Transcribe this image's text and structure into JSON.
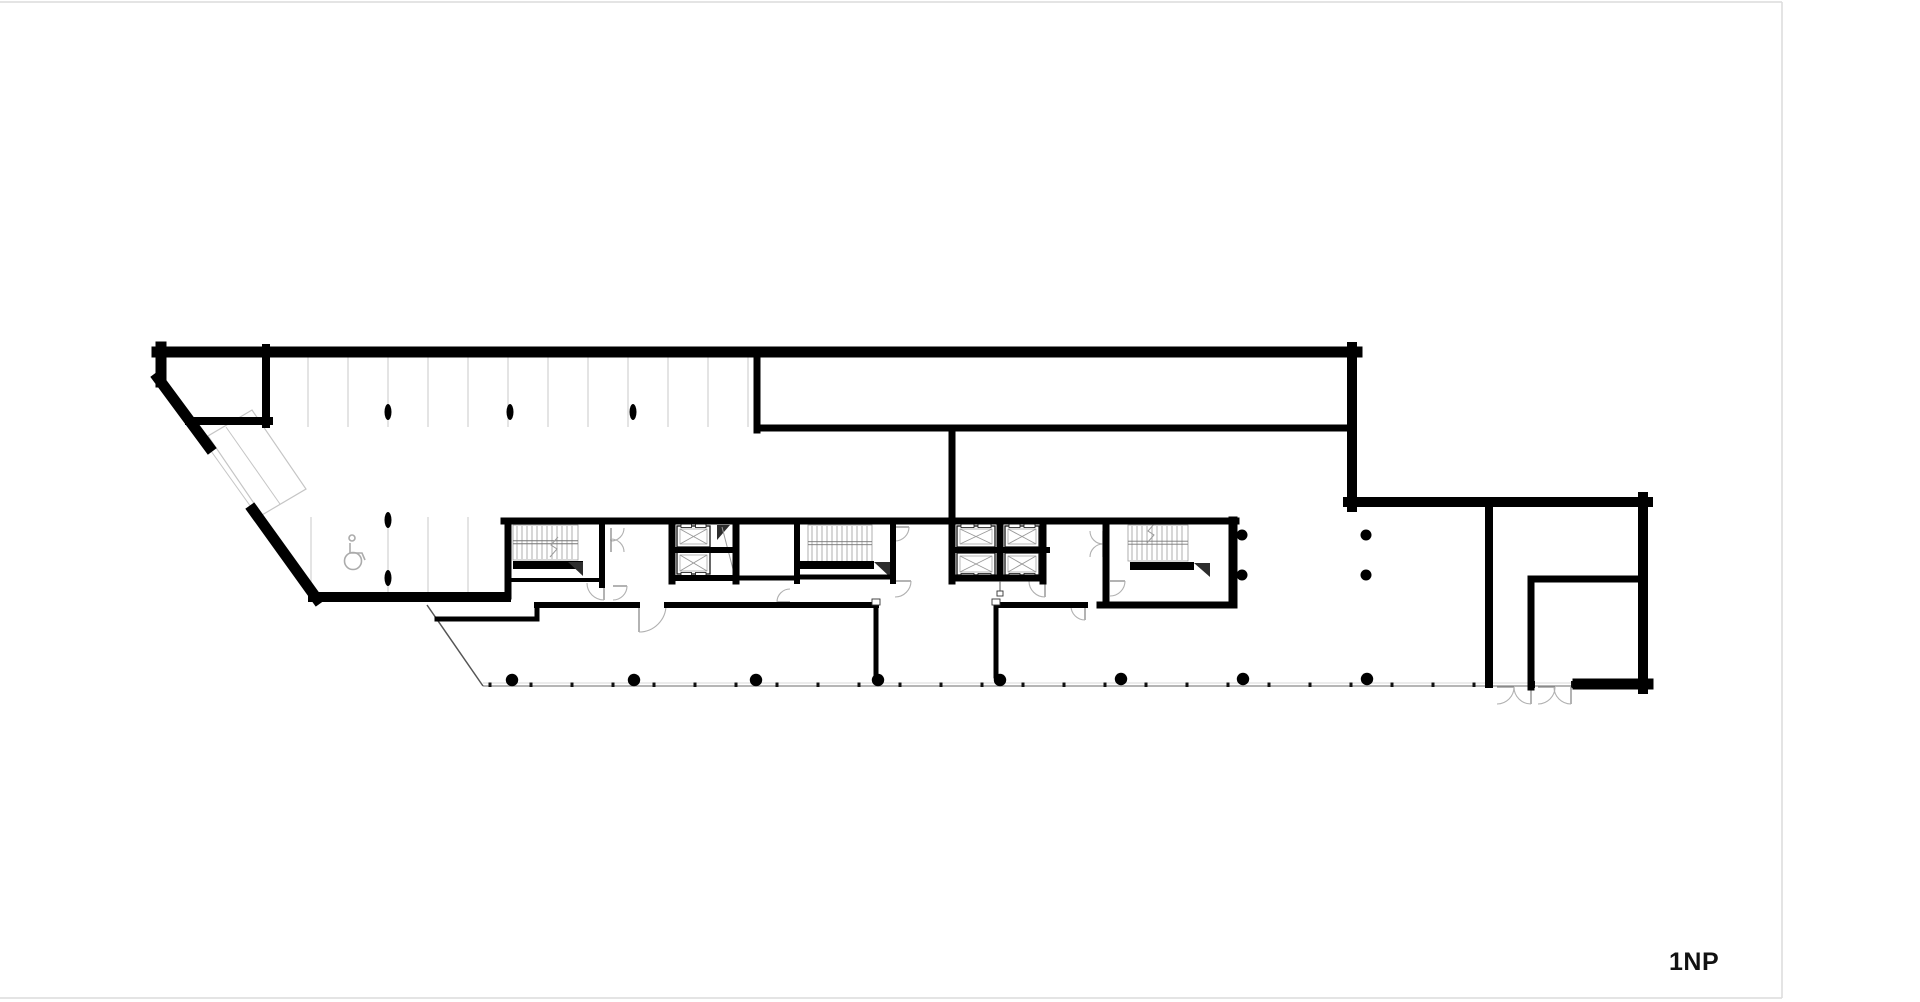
{
  "label": {
    "text": "1NP"
  },
  "page": {
    "width": 1782,
    "height": 998,
    "border_color": "#dcdcdc",
    "background": "#ffffff"
  },
  "colors": {
    "wall": "#000000",
    "detail": "#9b9b9b",
    "stripe": "#d2d2d2",
    "ramp": "#c5c5c5",
    "door": "#b0b0b0",
    "door_leaf": "#8a8a8a",
    "wedge": "#2d2d2d",
    "facade": "#8a8a8a",
    "facade_light": "#d8d8d8",
    "icon": "#ababab",
    "glazing": "#555555",
    "text": "#111111"
  },
  "plan": {
    "walls": [
      [
        157,
        352,
        1357,
        352,
        11
      ],
      [
        1352,
        347,
        1352,
        507,
        10
      ],
      [
        1348,
        502,
        1648,
        502,
        10
      ],
      [
        1643,
        497,
        1643,
        689,
        10
      ],
      [
        1578,
        684,
        1648,
        684,
        11
      ],
      [
        161,
        347,
        161,
        382,
        11
      ],
      [
        158,
        378,
        209,
        447,
        11
      ],
      [
        253,
        510,
        317,
        599,
        11
      ],
      [
        313,
        597,
        506,
        597,
        10
      ],
      [
        266,
        348,
        266,
        424,
        8
      ],
      [
        189,
        421,
        269,
        421,
        8
      ],
      [
        757,
        353,
        757,
        430,
        7
      ],
      [
        757,
        428,
        1351,
        428,
        7
      ],
      [
        952,
        428,
        952,
        581,
        7
      ],
      [
        504,
        521,
        1236,
        521,
        7
      ],
      [
        508,
        521,
        508,
        596,
        7
      ],
      [
        602,
        524,
        602,
        585,
        6
      ],
      [
        672,
        521,
        672,
        581,
        7
      ],
      [
        736,
        521,
        736,
        581,
        7
      ],
      [
        797,
        521,
        797,
        581,
        6
      ],
      [
        893,
        521,
        893,
        581,
        6
      ],
      [
        1000,
        524,
        1000,
        578,
        7
      ],
      [
        1043,
        521,
        1043,
        581,
        7
      ],
      [
        1106,
        521,
        1106,
        604,
        7
      ],
      [
        1233,
        521,
        1233,
        604,
        9
      ],
      [
        952,
        550,
        1047,
        550,
        6
      ],
      [
        952,
        578,
        1043,
        578,
        7
      ],
      [
        672,
        550,
        736,
        550,
        6
      ],
      [
        672,
        578,
        736,
        578,
        6
      ],
      [
        736,
        578,
        797,
        578,
        5
      ],
      [
        508,
        580,
        602,
        580,
        4
      ],
      [
        797,
        577,
        893,
        577,
        5
      ],
      [
        537,
        605,
        637,
        605,
        6
      ],
      [
        667,
        605,
        876,
        605,
        6
      ],
      [
        1000,
        605,
        1085,
        605,
        6
      ],
      [
        1100,
        605,
        1233,
        605,
        7
      ],
      [
        437,
        619,
        537,
        619,
        5
      ],
      [
        537,
        605,
        537,
        619,
        5
      ],
      [
        876,
        605,
        876,
        676,
        5
      ],
      [
        996,
        605,
        996,
        676,
        5
      ],
      [
        1489,
        502,
        1489,
        684,
        8
      ],
      [
        1531,
        579,
        1531,
        687,
        7
      ],
      [
        1531,
        579,
        1643,
        579,
        7
      ]
    ],
    "glazing_diagonal": [
      427,
      605,
      483,
      686
    ],
    "stair_bands": [
      [
        513,
        561,
        70,
        8
      ],
      [
        797,
        561,
        77,
        8
      ],
      [
        1130,
        562,
        64,
        8
      ]
    ],
    "wedges": [
      [
        568,
        562,
        583,
        562,
        583,
        576
      ],
      [
        874,
        562,
        890,
        562,
        890,
        577
      ],
      [
        1194,
        563,
        1210,
        563,
        1210,
        577
      ],
      [
        717,
        525,
        730,
        525,
        717,
        540
      ]
    ],
    "chute_line": [
      722,
      527,
      734,
      573
    ],
    "stairs": [
      {
        "x": 513,
        "y": 525,
        "w": 65,
        "h": 35
      },
      {
        "x": 808,
        "y": 525,
        "w": 64,
        "h": 37
      },
      {
        "x": 1128,
        "y": 525,
        "w": 60,
        "h": 36
      }
    ],
    "zigzags": [
      [
        550,
        557,
        557,
        549,
        551,
        545,
        558,
        537
      ],
      [
        1147,
        543,
        1154,
        535,
        1148,
        531,
        1155,
        523
      ]
    ],
    "elevators": [
      {
        "x": 677,
        "y": 526,
        "w": 33,
        "h": 21,
        "door": "top"
      },
      {
        "x": 677,
        "y": 552,
        "w": 33,
        "h": 22,
        "door": "bottom"
      },
      {
        "x": 957,
        "y": 526,
        "w": 38,
        "h": 21,
        "door": "top"
      },
      {
        "x": 1005,
        "y": 526,
        "w": 34,
        "h": 21,
        "door": "top"
      },
      {
        "x": 957,
        "y": 553,
        "w": 38,
        "h": 22,
        "door": "bottom"
      },
      {
        "x": 1005,
        "y": 553,
        "w": 34,
        "h": 22,
        "door": "bottom"
      }
    ],
    "doors": [
      [
        611,
        528,
        13,
        90,
        0
      ],
      [
        611,
        552,
        13,
        -90,
        0
      ],
      [
        604,
        583,
        17,
        90,
        180
      ],
      [
        613,
        586,
        14,
        0,
        90
      ],
      [
        639,
        605,
        27,
        90,
        0
      ],
      [
        895,
        527,
        14,
        0,
        90
      ],
      [
        895,
        581,
        16,
        0,
        90
      ],
      [
        1045,
        581,
        16,
        90,
        180
      ],
      [
        1103,
        531,
        13,
        90,
        180
      ],
      [
        1103,
        557,
        13,
        270,
        180
      ],
      [
        1110,
        581,
        15,
        0,
        90
      ],
      [
        1085,
        606,
        14,
        90,
        180
      ],
      [
        790,
        602,
        13,
        180,
        270
      ],
      [
        1497,
        687,
        17,
        0,
        90
      ],
      [
        1531,
        687,
        17,
        90,
        180
      ],
      [
        1538,
        687,
        17,
        0,
        90
      ],
      [
        1571,
        687,
        17,
        90,
        180
      ]
    ],
    "parking": {
      "top_xs": [
        308,
        348,
        388,
        428,
        468,
        508,
        548,
        588,
        628,
        668,
        708,
        748
      ],
      "top_y1": 356,
      "top_y2": 427,
      "low_xs": [
        311,
        388,
        428,
        468
      ],
      "low_y1": 517,
      "low_y2": 594
    },
    "ramp": {
      "outline": [
        252,
        410,
        306,
        489,
        262,
        515,
        208,
        436
      ],
      "mid_line": [
        226,
        427,
        280,
        504
      ],
      "opening_line": [
        206,
        444,
        256,
        514
      ]
    },
    "facade": {
      "x1": 483,
      "x2": 1578,
      "y": 686,
      "y_light": 683,
      "tick_xs": [
        490,
        531,
        572,
        613,
        654,
        695,
        736,
        777,
        818,
        859,
        900,
        941,
        982,
        1023,
        1064,
        1105,
        1146,
        1187,
        1228,
        1269,
        1310,
        1351,
        1392,
        1433,
        1474
      ],
      "post_xs": [
        1490,
        1533,
        1573
      ]
    },
    "columns": {
      "oval": [
        [
          388,
          412
        ],
        [
          510,
          412
        ],
        [
          633,
          412
        ],
        [
          388,
          520
        ],
        [
          388,
          578
        ]
      ],
      "round_large": [
        [
          512,
          680
        ],
        [
          634,
          680
        ],
        [
          756,
          680
        ],
        [
          878,
          680
        ],
        [
          1000,
          680
        ],
        [
          1121,
          679
        ],
        [
          1243,
          679
        ],
        [
          1367,
          679
        ]
      ],
      "round_small": [
        [
          1242,
          535
        ],
        [
          1242,
          575
        ],
        [
          1366,
          535
        ],
        [
          1366,
          575
        ]
      ]
    },
    "wheelchair": {
      "cx": 354,
      "cy": 552
    },
    "squares": [
      [
        997,
        591,
        6,
        5
      ],
      [
        872,
        599,
        8,
        6
      ],
      [
        992,
        599,
        8,
        6
      ]
    ],
    "pedestal_line": [
      1000,
      581,
      1000,
      591
    ]
  }
}
